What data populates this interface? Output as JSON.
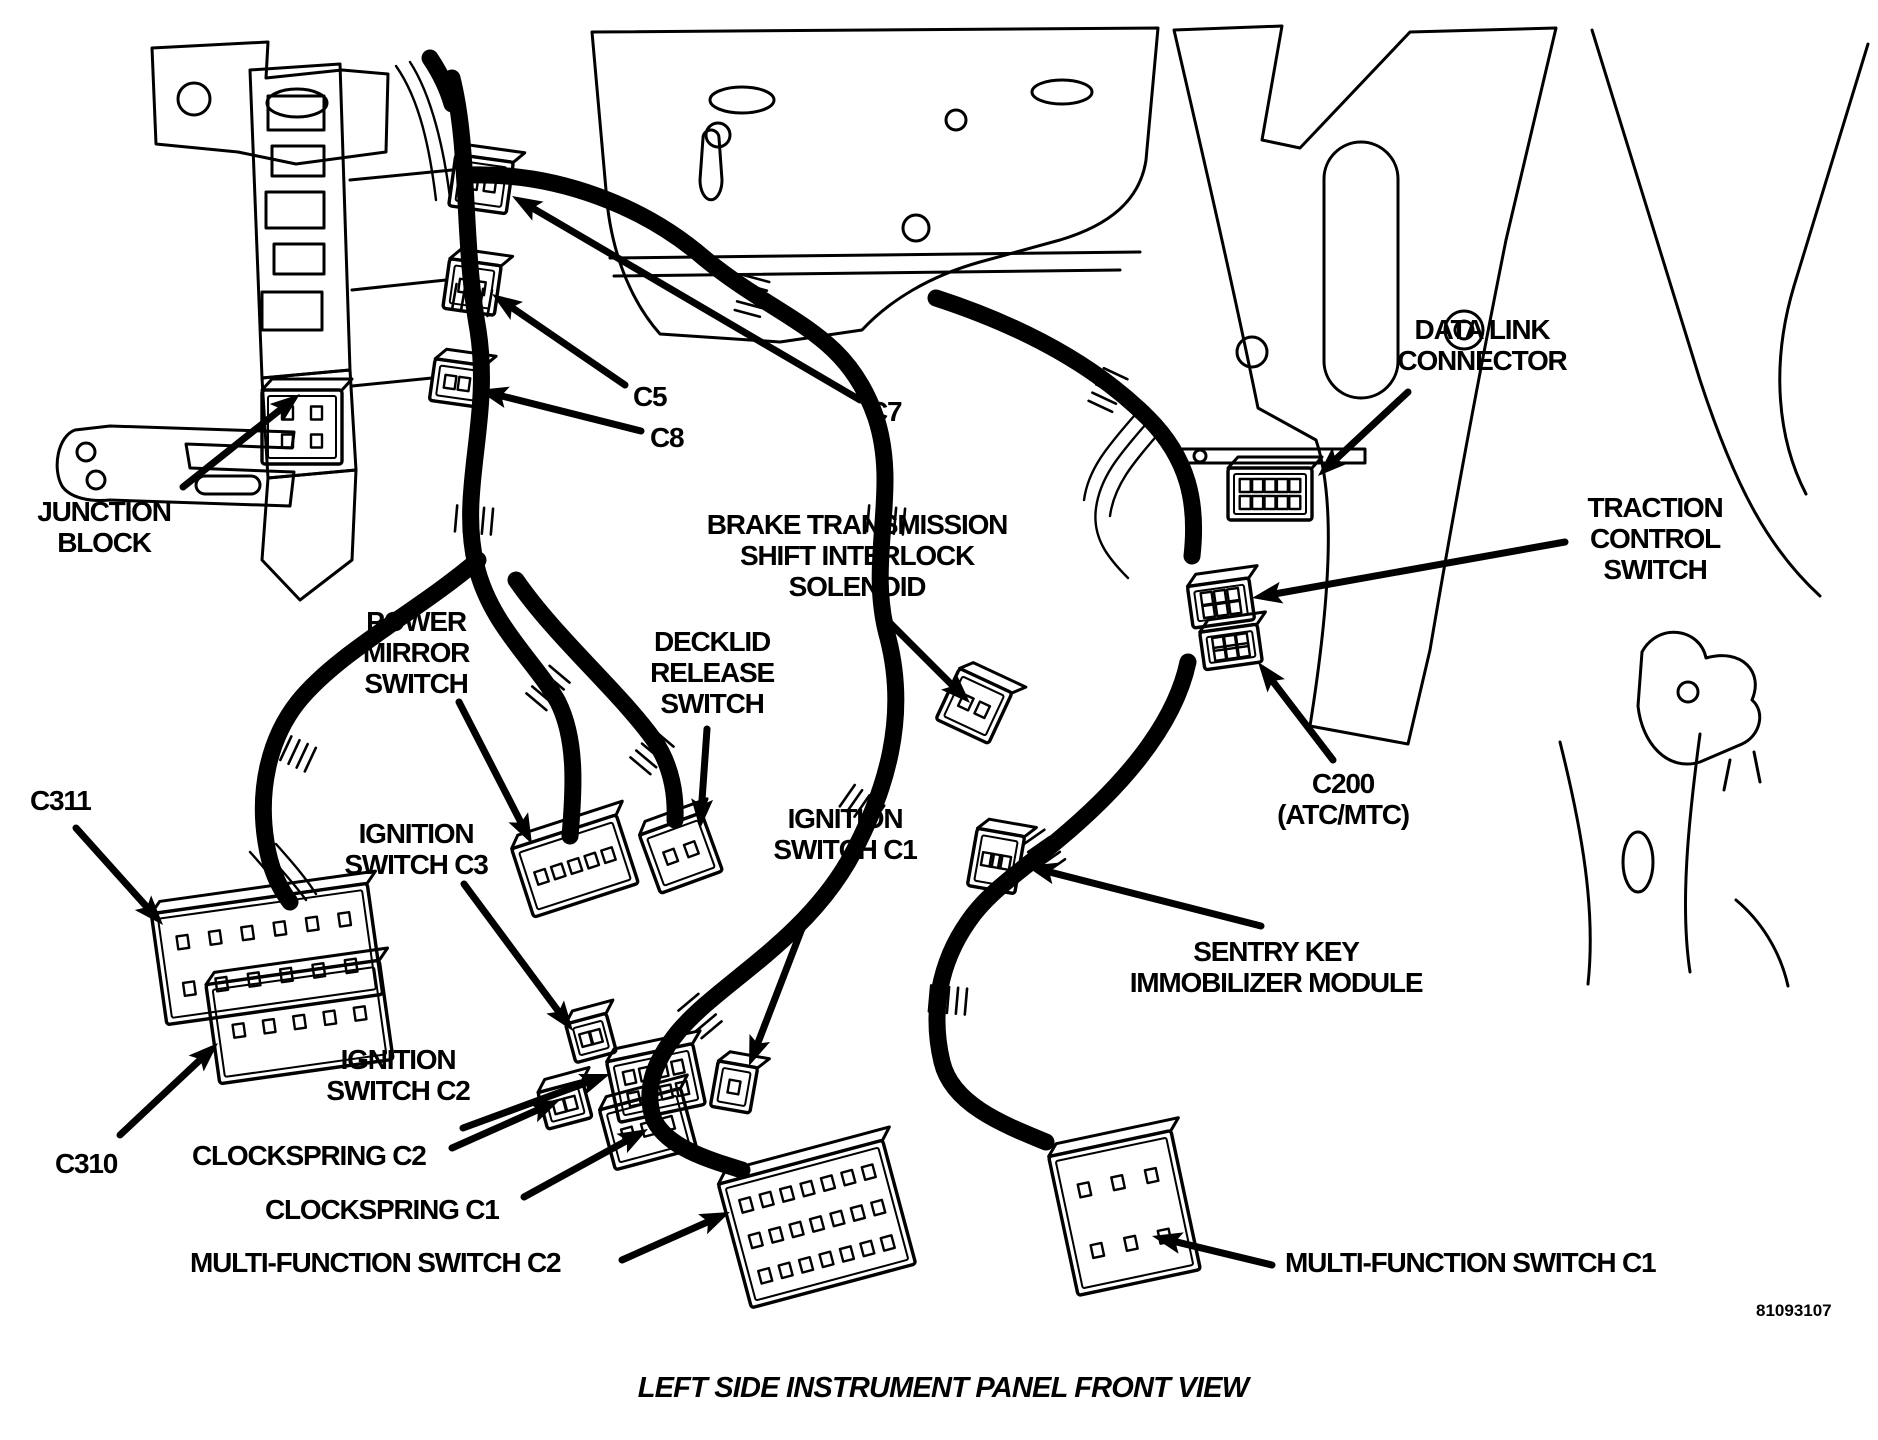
{
  "figure": {
    "caption": "LEFT SIDE INSTRUMENT PANEL FRONT VIEW",
    "figure_number": "81093107",
    "ink_color": "#000000",
    "background_color": "#ffffff"
  },
  "labels": {
    "junction_block": {
      "lines": [
        "JUNCTION",
        "BLOCK"
      ]
    },
    "c5": {
      "lines": [
        "C5"
      ]
    },
    "c8": {
      "lines": [
        "C8"
      ]
    },
    "c7": {
      "lines": [
        "C7"
      ]
    },
    "data_link": {
      "lines": [
        "DATA LINK",
        "CONNECTOR"
      ]
    },
    "traction": {
      "lines": [
        "TRACTION",
        "CONTROL",
        "SWITCH"
      ]
    },
    "btsi": {
      "lines": [
        "BRAKE TRANSMISSION",
        "SHIFT INTERLOCK",
        "SOLENOID"
      ]
    },
    "power_mirror": {
      "lines": [
        "POWER",
        "MIRROR",
        "SWITCH"
      ]
    },
    "decklid": {
      "lines": [
        "DECKLID",
        "RELEASE",
        "SWITCH"
      ]
    },
    "c311": {
      "lines": [
        "C311"
      ]
    },
    "ignition_c3": {
      "lines": [
        "IGNITION",
        "SWITCH C3"
      ]
    },
    "ignition_c1": {
      "lines": [
        "IGNITION",
        "SWITCH C1"
      ]
    },
    "c200": {
      "lines": [
        "C200",
        "(ATC/MTC)"
      ]
    },
    "sentry": {
      "lines": [
        "SENTRY KEY",
        "IMMOBILIZER MODULE"
      ]
    },
    "ignition_c2": {
      "lines": [
        "IGNITION",
        "SWITCH C2"
      ]
    },
    "c310": {
      "lines": [
        "C310"
      ]
    },
    "clockspring_c2": {
      "lines": [
        "CLOCKSPRING C2"
      ]
    },
    "clockspring_c1": {
      "lines": [
        "CLOCKSPRING C1"
      ]
    },
    "mfs_c2": {
      "lines": [
        "MULTI-FUNCTION SWITCH C2"
      ]
    },
    "mfs_c1": {
      "lines": [
        "MULTI-FUNCTION SWITCH C1"
      ]
    }
  },
  "arrows": [
    {
      "name": "junction-block-arrow",
      "from": [
        183,
        487
      ],
      "to": [
        300,
        394
      ]
    },
    {
      "name": "c5-arrow",
      "from": [
        625,
        385
      ],
      "to": [
        492,
        294
      ]
    },
    {
      "name": "c8-arrow",
      "from": [
        641,
        431
      ],
      "to": [
        478,
        390
      ]
    },
    {
      "name": "c7-arrow",
      "from": [
        860,
        400
      ],
      "to": [
        512,
        196
      ]
    },
    {
      "name": "data-link-arrow",
      "from": [
        1408,
        392
      ],
      "to": [
        1318,
        476
      ]
    },
    {
      "name": "traction-arrow",
      "from": [
        1565,
        542
      ],
      "to": [
        1252,
        598
      ]
    },
    {
      "name": "c200-arrow",
      "from": [
        1333,
        760
      ],
      "to": [
        1258,
        662
      ]
    },
    {
      "name": "btsi-arrow",
      "from": [
        884,
        617
      ],
      "to": [
        970,
        703
      ]
    },
    {
      "name": "power-mirror-arrow",
      "from": [
        459,
        702
      ],
      "to": [
        532,
        844
      ]
    },
    {
      "name": "decklid-arrow",
      "from": [
        707,
        729
      ],
      "to": [
        700,
        829
      ]
    },
    {
      "name": "ignition-c3-arrow",
      "from": [
        464,
        884
      ],
      "to": [
        573,
        1031
      ]
    },
    {
      "name": "ignition-c1-arrow",
      "from": [
        806,
        918
      ],
      "to": [
        749,
        1066
      ]
    },
    {
      "name": "sentry-arrow",
      "from": [
        1261,
        926
      ],
      "to": [
        1026,
        866
      ]
    },
    {
      "name": "ignition-c2-arrow",
      "from": [
        463,
        1128
      ],
      "to": [
        610,
        1074
      ]
    },
    {
      "name": "clockspring-c2-arrow",
      "from": [
        452,
        1148
      ],
      "to": [
        560,
        1100
      ]
    },
    {
      "name": "clockspring-c1-arrow",
      "from": [
        524,
        1197
      ],
      "to": [
        648,
        1129
      ]
    },
    {
      "name": "mfs-c2-arrow",
      "from": [
        622,
        1260
      ],
      "to": [
        730,
        1212
      ]
    },
    {
      "name": "mfs-c1-arrow",
      "from": [
        1272,
        1265
      ],
      "to": [
        1152,
        1236
      ]
    },
    {
      "name": "c311-arrow",
      "from": [
        76,
        828
      ],
      "to": [
        163,
        925
      ]
    },
    {
      "name": "c310-arrow",
      "from": [
        120,
        1135
      ],
      "to": [
        218,
        1043
      ]
    }
  ],
  "connectors": [
    {
      "name": "junction-block-connector",
      "x": 262,
      "y": 390,
      "w": 80,
      "h": 74,
      "rot": 0,
      "rows": 2,
      "cols": 2
    },
    {
      "name": "c7-connector",
      "x": 452,
      "y": 158,
      "w": 58,
      "h": 52,
      "rot": 8,
      "rows": 1,
      "cols": 2
    },
    {
      "name": "c5-connector",
      "x": 446,
      "y": 262,
      "w": 52,
      "h": 50,
      "rot": 8,
      "rows": 1,
      "cols": 2
    },
    {
      "name": "c8-connector",
      "x": 432,
      "y": 362,
      "w": 50,
      "h": 42,
      "rot": 8,
      "rows": 1,
      "cols": 2
    },
    {
      "name": "data-link-connector",
      "x": 1228,
      "y": 468,
      "w": 84,
      "h": 52,
      "rot": 0,
      "rows": 2,
      "cols": 5
    },
    {
      "name": "traction-control-connector",
      "x": 1190,
      "y": 582,
      "w": 62,
      "h": 42,
      "rot": -8,
      "rows": 2,
      "cols": 3
    },
    {
      "name": "c200-connector",
      "x": 1202,
      "y": 628,
      "w": 58,
      "h": 38,
      "rot": -8,
      "rows": 2,
      "cols": 3
    },
    {
      "name": "power-mirror-connector",
      "x": 520,
      "y": 830,
      "w": 110,
      "h": 72,
      "rot": -18,
      "rows": 1,
      "cols": 5
    },
    {
      "name": "decklid-connector",
      "x": 648,
      "y": 822,
      "w": 66,
      "h": 62,
      "rot": -20,
      "rows": 1,
      "cols": 2
    },
    {
      "name": "btsi-connector",
      "x": 945,
      "y": 678,
      "w": 58,
      "h": 56,
      "rot": 25,
      "rows": 1,
      "cols": 2
    },
    {
      "name": "sentry-connector",
      "x": 972,
      "y": 832,
      "w": 48,
      "h": 58,
      "rot": 10,
      "rows": 1,
      "cols": 3
    },
    {
      "name": "ignition-c3-connector",
      "x": 570,
      "y": 1018,
      "w": 42,
      "h": 40,
      "rot": -15,
      "rows": 1,
      "cols": 2
    },
    {
      "name": "ignition-c2-connector",
      "x": 612,
      "y": 1052,
      "w": 88,
      "h": 62,
      "rot": -12,
      "rows": 2,
      "cols": 4
    },
    {
      "name": "ignition-c1-connector",
      "x": 714,
      "y": 1064,
      "w": 40,
      "h": 46,
      "rot": 10,
      "rows": 1,
      "cols": 1
    },
    {
      "name": "clockspring-c2-connector",
      "x": 542,
      "y": 1086,
      "w": 46,
      "h": 38,
      "rot": -15,
      "rows": 1,
      "cols": 2
    },
    {
      "name": "clockspring-c1-connector",
      "x": 606,
      "y": 1098,
      "w": 84,
      "h": 62,
      "rot": -15,
      "rows": 1,
      "cols": 3
    },
    {
      "name": "c311-connector",
      "x": 158,
      "y": 898,
      "w": 218,
      "h": 112,
      "rot": -8,
      "rows": 2,
      "cols": 6
    },
    {
      "name": "c310-connector",
      "x": 212,
      "y": 972,
      "w": 175,
      "h": 100,
      "rot": -8,
      "rows": 1,
      "cols": 5
    },
    {
      "name": "multi-function-c2-connector",
      "x": 732,
      "y": 1160,
      "w": 170,
      "h": 128,
      "rot": -15,
      "rows": 3,
      "cols": 7
    },
    {
      "name": "multi-function-c1-connector",
      "x": 1062,
      "y": 1142,
      "w": 125,
      "h": 142,
      "rot": -12,
      "rows": 2,
      "cols": 3
    }
  ]
}
